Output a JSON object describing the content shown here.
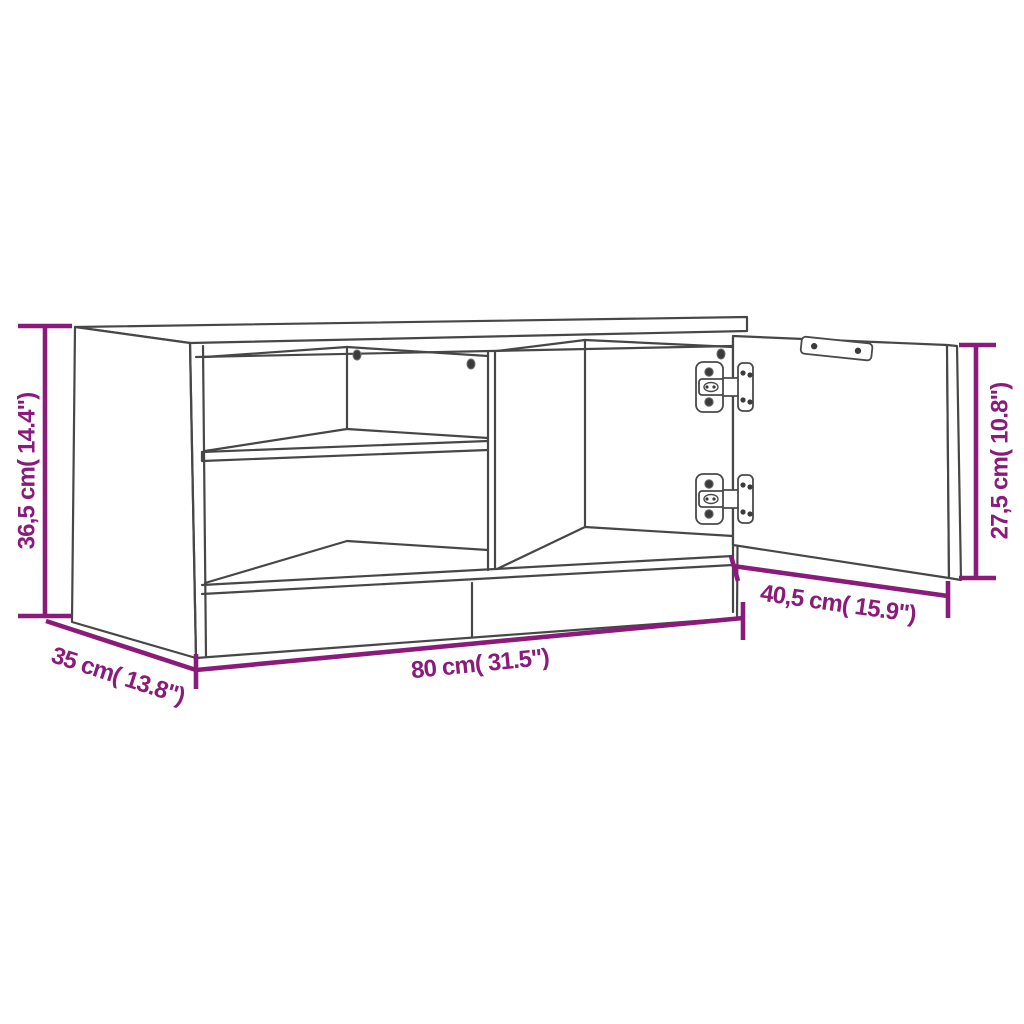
{
  "diagram": {
    "title": "TV cabinet dimension diagram",
    "background_color": "#FFFFFF",
    "outline_color": "#474747",
    "dimension_color": "#8B1B7A",
    "dimensions": {
      "height_left": "36,5 cm( 14.4\")",
      "depth_left": "35 cm( 13.8\")",
      "width_bottom": "80 cm( 31.5\")",
      "door_width_right": "40,5 cm( 15.9\")",
      "door_height_right": "27,5 cm( 10.8\")"
    },
    "measurements": {
      "overall_height": {
        "cm": "36,5",
        "inches": "14.4"
      },
      "overall_depth": {
        "cm": "35",
        "inches": "13.8"
      },
      "overall_width": {
        "cm": "80",
        "inches": "31.5"
      },
      "door_width": {
        "cm": "40,5",
        "inches": "15.9"
      },
      "door_height": {
        "cm": "27,5",
        "inches": "10.8"
      }
    },
    "parts": {
      "hinge_count": 2,
      "shelf_count": 1,
      "icons": [
        "hinge-icon",
        "screw-icon",
        "mounting-plate-icon"
      ]
    }
  }
}
